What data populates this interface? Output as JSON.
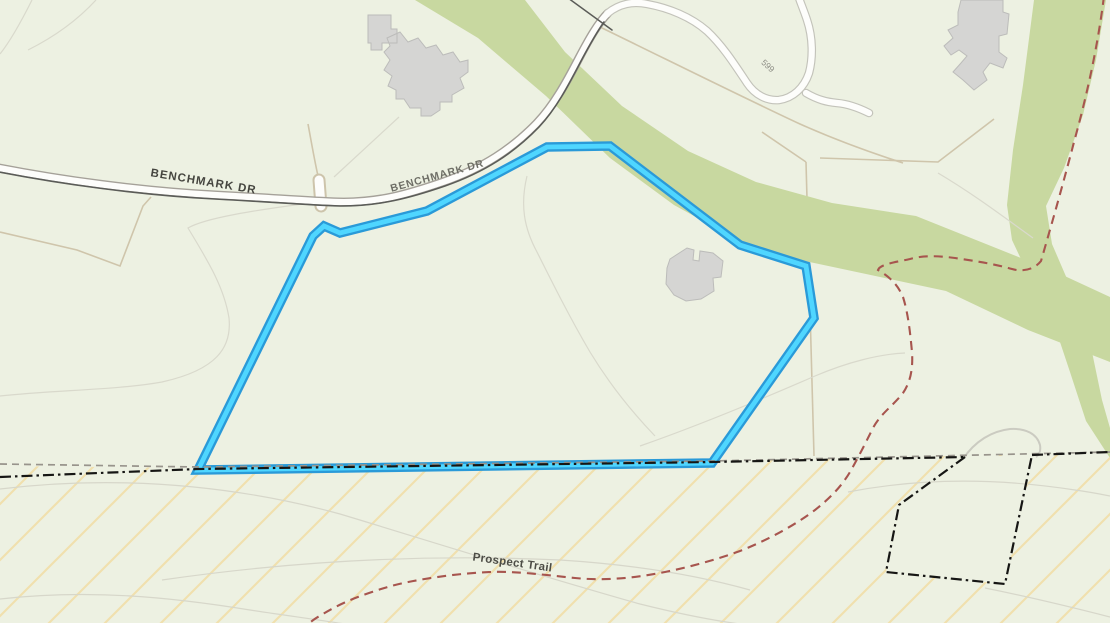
{
  "map": {
    "type": "topographic-parcel-map",
    "road_labels": [
      {
        "text": "BENCHMARK DR"
      },
      {
        "text": "BENCHMARK DR"
      }
    ],
    "trail_label": {
      "text": "Prospect Trail"
    },
    "contour_label": {
      "text": "599"
    },
    "colors": {
      "background": "#edf1e2",
      "parcel_highlight_inner": "#4fd6ff",
      "parcel_highlight_casing": "#2a9ad8",
      "greenway_fill": "#c8d8a0",
      "road_fill": "#fdfdfb",
      "road_casing": "#a5a199",
      "road_dark_edge": "#5b5c58",
      "building_fill": "#d5d5d3",
      "building_outline": "#bcbcba",
      "trail_dashed": "#a7554e",
      "boundary_black_dashdot": "#161614",
      "boundary_gray_dashed": "#98948c",
      "hatch_line": "#f0e0ae",
      "parcel_line_tan": "#cfc5ab",
      "contour_line": "#d9d9cc",
      "label_dark": "#45453f",
      "label_gray": "#6e6e66"
    },
    "features": [
      "highlighted-parcel-boundary",
      "benchmark-drive-road",
      "switchback-road",
      "greenway-corridor",
      "buildings",
      "prospect-trail",
      "town-boundary-dashdot",
      "hatched-overlay-area",
      "contour-lines"
    ]
  }
}
